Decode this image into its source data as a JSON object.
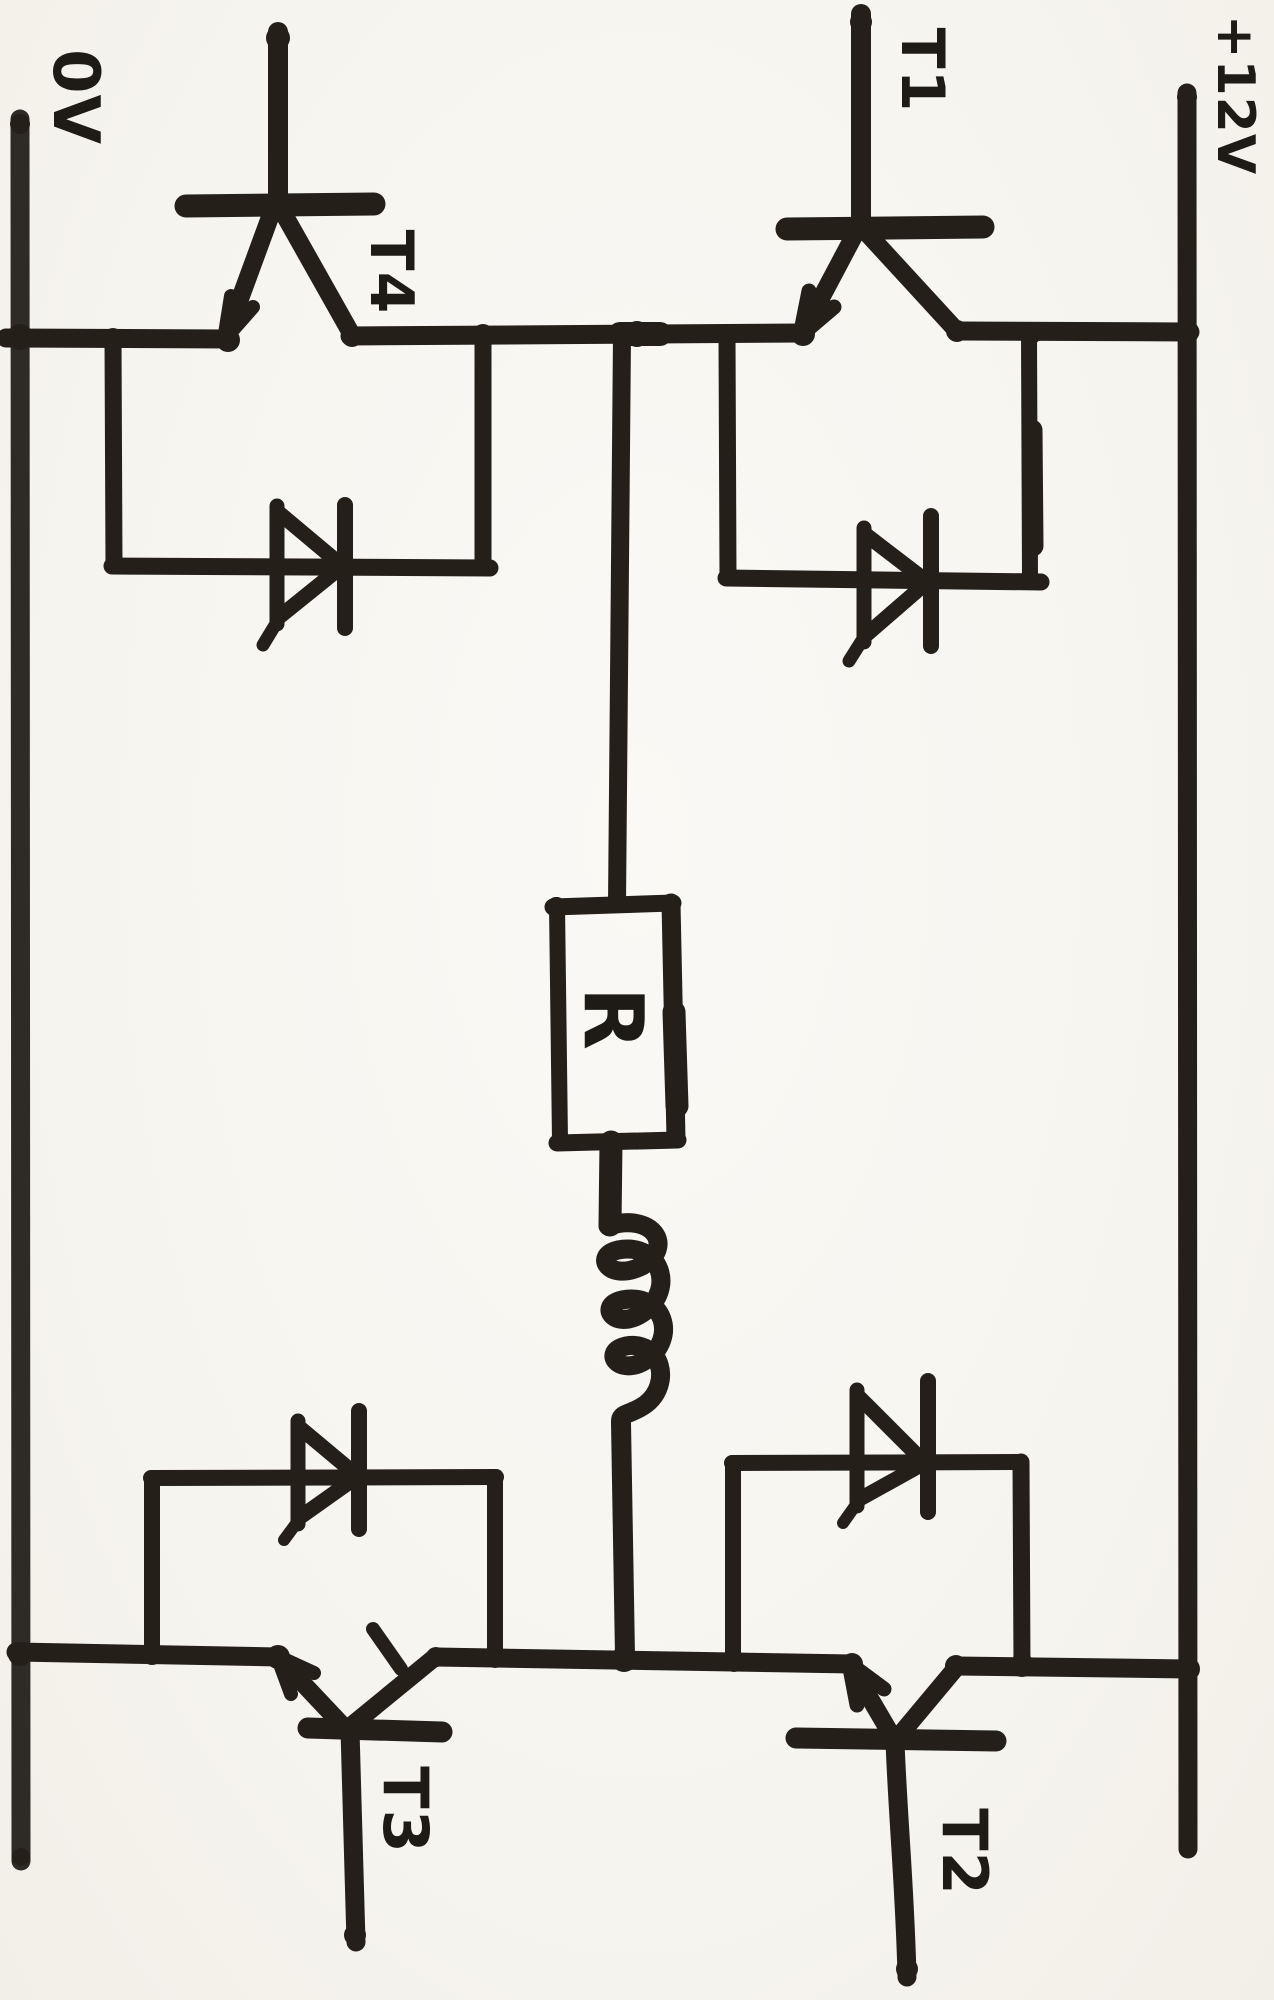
{
  "document": {
    "kind": "hand-drawn circuit schematic (scanned marker sketch, drawn sideways)",
    "topology": "H-bridge: four transistors with flyback diodes driving a series R-L load between the half-bridge midpoints"
  },
  "labels": {
    "left_rail": "0V",
    "right_rail": "+12V",
    "transistor_top_left": "T4",
    "transistor_top_right": "T1",
    "transistor_bottom_left": "T3",
    "transistor_bottom_right": "T2",
    "resistor": "R"
  },
  "components": {
    "transistors": [
      "T1",
      "T2",
      "T3",
      "T4"
    ],
    "flyback_diodes": 4,
    "resistor": "R",
    "inductor": "coil in series below R",
    "rails": [
      "0V",
      "+12V"
    ]
  },
  "colors": {
    "ink": "#242019",
    "paper": "#f7f5f0"
  }
}
